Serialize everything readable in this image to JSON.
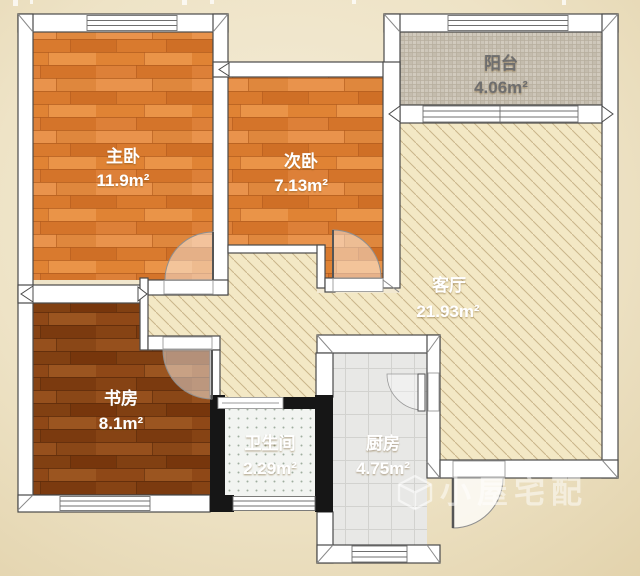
{
  "rooms": {
    "master_bedroom": {
      "name": "主卧",
      "area": "11.9m²"
    },
    "second_bedroom": {
      "name": "次卧",
      "area": "7.13m²"
    },
    "balcony": {
      "name": "阳台",
      "area": "4.06m²"
    },
    "living_room": {
      "name": "客厅",
      "area": "21.93m²"
    },
    "study": {
      "name": "书房",
      "area": "8.1m²"
    },
    "bathroom": {
      "name": "卫生间",
      "area": "2.29m²"
    },
    "kitchen": {
      "name": "厨房",
      "area": "4.75m²"
    }
  },
  "watermark": {
    "text": "小屋宅配",
    "icon": "cube-logo-icon"
  },
  "colors": {
    "background": "#eee3c6",
    "wall_fill": "#ffffff",
    "wall_outline": "#4a4a4a",
    "black_wall": "#161616",
    "wood_floor": "#dd7e2f",
    "dark_wood_floor": "#8a4313",
    "living_floor": "#f3e8c5",
    "balcony_floor": "#cdc6b9",
    "kitchen_floor": "#e8e8e6",
    "bathroom_floor": "#f2f4f1",
    "label_text": "#ffffff",
    "balcony_label_text": "#6e6e6e",
    "watermark_text": "rgba(255,255,255,0.5)"
  }
}
